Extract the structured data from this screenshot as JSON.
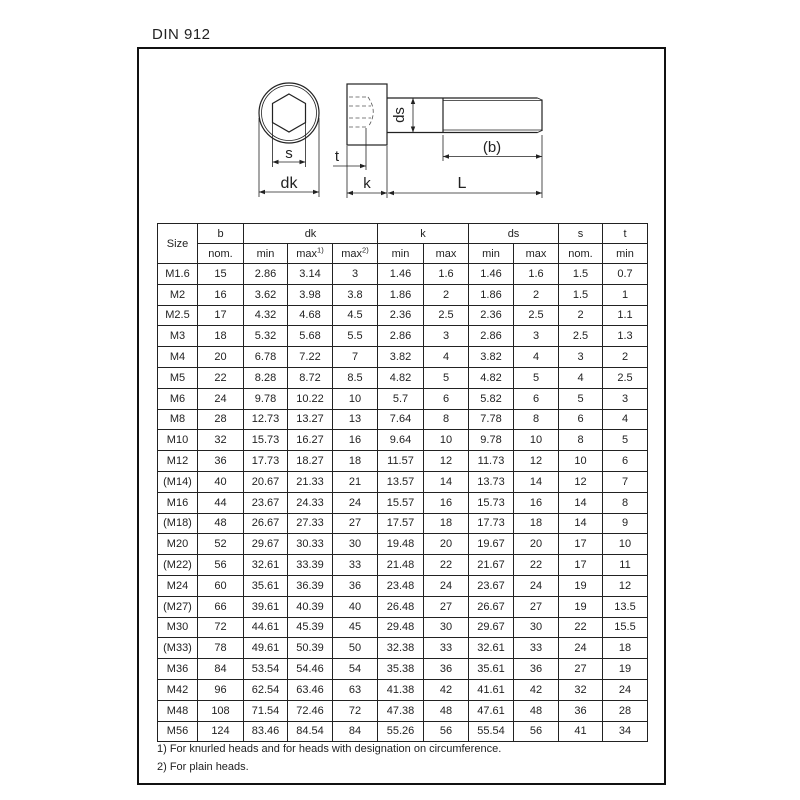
{
  "page": {
    "title": "DIN 912"
  },
  "diagram": {
    "labels": {
      "s": "s",
      "dk": "dk",
      "t": "t",
      "k": "k",
      "L": "L",
      "ds": "ds",
      "b": "(b)"
    }
  },
  "table": {
    "columns": {
      "size": "Size",
      "b": {
        "label": "b",
        "sub": "nom."
      },
      "dk": {
        "label": "dk",
        "min": "min",
        "max1_label": "max",
        "max1_sup": "1)",
        "max2_label": "max",
        "max2_sup": "2)"
      },
      "k": {
        "label": "k",
        "min": "min",
        "max": "max"
      },
      "ds": {
        "label": "ds",
        "min": "min",
        "max": "max"
      },
      "s": {
        "label": "s",
        "sub": "nom."
      },
      "t": {
        "label": "t",
        "sub": "min"
      }
    },
    "rows": [
      [
        "M1.6",
        "15",
        "2.86",
        "3.14",
        "3",
        "1.46",
        "1.6",
        "1.46",
        "1.6",
        "1.5",
        "0.7"
      ],
      [
        "M2",
        "16",
        "3.62",
        "3.98",
        "3.8",
        "1.86",
        "2",
        "1.86",
        "2",
        "1.5",
        "1"
      ],
      [
        "M2.5",
        "17",
        "4.32",
        "4.68",
        "4.5",
        "2.36",
        "2.5",
        "2.36",
        "2.5",
        "2",
        "1.1"
      ],
      [
        "M3",
        "18",
        "5.32",
        "5.68",
        "5.5",
        "2.86",
        "3",
        "2.86",
        "3",
        "2.5",
        "1.3"
      ],
      [
        "M4",
        "20",
        "6.78",
        "7.22",
        "7",
        "3.82",
        "4",
        "3.82",
        "4",
        "3",
        "2"
      ],
      [
        "M5",
        "22",
        "8.28",
        "8.72",
        "8.5",
        "4.82",
        "5",
        "4.82",
        "5",
        "4",
        "2.5"
      ],
      [
        "M6",
        "24",
        "9.78",
        "10.22",
        "10",
        "5.7",
        "6",
        "5.82",
        "6",
        "5",
        "3"
      ],
      [
        "M8",
        "28",
        "12.73",
        "13.27",
        "13",
        "7.64",
        "8",
        "7.78",
        "8",
        "6",
        "4"
      ],
      [
        "M10",
        "32",
        "15.73",
        "16.27",
        "16",
        "9.64",
        "10",
        "9.78",
        "10",
        "8",
        "5"
      ],
      [
        "M12",
        "36",
        "17.73",
        "18.27",
        "18",
        "11.57",
        "12",
        "11.73",
        "12",
        "10",
        "6"
      ],
      [
        "(M14)",
        "40",
        "20.67",
        "21.33",
        "21",
        "13.57",
        "14",
        "13.73",
        "14",
        "12",
        "7"
      ],
      [
        "M16",
        "44",
        "23.67",
        "24.33",
        "24",
        "15.57",
        "16",
        "15.73",
        "16",
        "14",
        "8"
      ],
      [
        "(M18)",
        "48",
        "26.67",
        "27.33",
        "27",
        "17.57",
        "18",
        "17.73",
        "18",
        "14",
        "9"
      ],
      [
        "M20",
        "52",
        "29.67",
        "30.33",
        "30",
        "19.48",
        "20",
        "19.67",
        "20",
        "17",
        "10"
      ],
      [
        "(M22)",
        "56",
        "32.61",
        "33.39",
        "33",
        "21.48",
        "22",
        "21.67",
        "22",
        "17",
        "11"
      ],
      [
        "M24",
        "60",
        "35.61",
        "36.39",
        "36",
        "23.48",
        "24",
        "23.67",
        "24",
        "19",
        "12"
      ],
      [
        "(M27)",
        "66",
        "39.61",
        "40.39",
        "40",
        "26.48",
        "27",
        "26.67",
        "27",
        "19",
        "13.5"
      ],
      [
        "M30",
        "72",
        "44.61",
        "45.39",
        "45",
        "29.48",
        "30",
        "29.67",
        "30",
        "22",
        "15.5"
      ],
      [
        "(M33)",
        "78",
        "49.61",
        "50.39",
        "50",
        "32.38",
        "33",
        "32.61",
        "33",
        "24",
        "18"
      ],
      [
        "M36",
        "84",
        "53.54",
        "54.46",
        "54",
        "35.38",
        "36",
        "35.61",
        "36",
        "27",
        "19"
      ],
      [
        "M42",
        "96",
        "62.54",
        "63.46",
        "63",
        "41.38",
        "42",
        "41.61",
        "42",
        "32",
        "24"
      ],
      [
        "M48",
        "108",
        "71.54",
        "72.46",
        "72",
        "47.38",
        "48",
        "47.61",
        "48",
        "36",
        "28"
      ],
      [
        "M56",
        "124",
        "83.46",
        "84.54",
        "84",
        "55.26",
        "56",
        "55.54",
        "56",
        "41",
        "34"
      ]
    ]
  },
  "footnotes": {
    "line1": "1) For knurled heads and for heads with designation on circumference.",
    "line2": "2) For plain heads."
  }
}
